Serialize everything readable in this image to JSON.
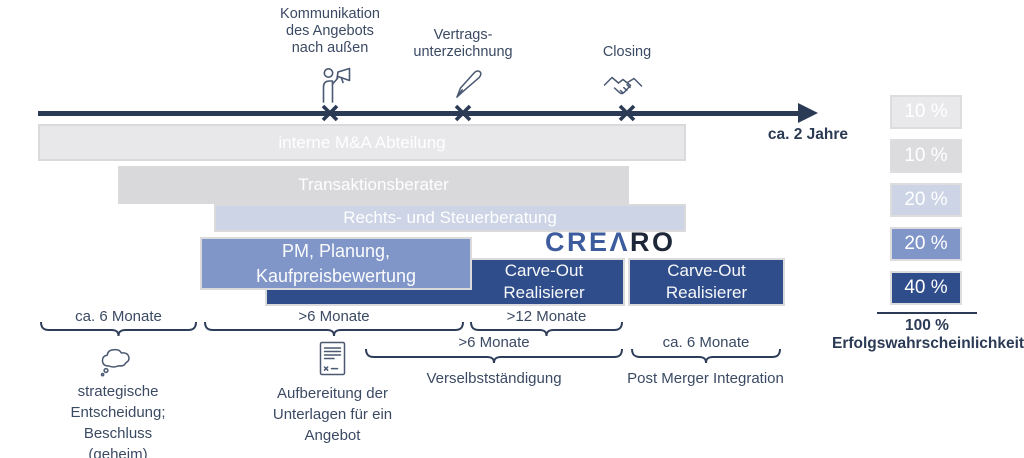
{
  "timeline": {
    "duration_label": "ca. 2 Jahre",
    "milestones": [
      {
        "label": "Kommunikation\ndes Angebots\nnach außen",
        "icon": "megaphone-person-icon"
      },
      {
        "label": "Vertrags-\nunterzeichnung",
        "icon": "pen-icon"
      },
      {
        "label": "Closing",
        "icon": "handshake-icon"
      }
    ]
  },
  "bars": [
    {
      "label": "interne M&A Abteilung",
      "color": "#e8e8eb"
    },
    {
      "label": "Transaktionsberater",
      "color": "#d9d9dc"
    },
    {
      "label": "Rechts- und Steuerberatung",
      "color": "#ccd4e6"
    },
    {
      "label": "PM, Planung,\nKaufpreisbewertung",
      "color": "#8096c8"
    },
    {
      "label": "Carve-Out\nRealisierer",
      "color": "#2f4d8a"
    },
    {
      "label": "Carve-Out\nRealisierer",
      "color": "#2f4d8a"
    }
  ],
  "logo": {
    "part1": "CRE",
    "part2": "Λ",
    "part3": "RO",
    "color_primary": "#3d5c9e",
    "color_dark": "#1d2737"
  },
  "probabilities": {
    "items": [
      {
        "value": "10 %",
        "color": "#e9e9ec"
      },
      {
        "value": "10 %",
        "color": "#dcdcdf"
      },
      {
        "value": "20 %",
        "color": "#ccd4e6"
      },
      {
        "value": "20 %",
        "color": "#8096c8"
      },
      {
        "value": "40 %",
        "color": "#2f4d8a"
      }
    ],
    "total_value": "100 %",
    "total_label": "Erfolgswahrscheinlichkeit"
  },
  "phases": {
    "row1": [
      {
        "label": "ca. 6 Monate"
      },
      {
        "label": ">6 Monate"
      },
      {
        "label": ">12 Monate"
      }
    ],
    "row2": [
      {
        "label": ">6 Monate"
      },
      {
        "label": "ca. 6 Monate"
      }
    ]
  },
  "notes": [
    {
      "icon": "thought-bubble-icon",
      "text": "strategische\nEntscheidung;\nBeschluss\n(geheim)"
    },
    {
      "icon": "document-icon",
      "text": "Aufbereitung der\nUnterlagen für ein\nAngebot"
    },
    {
      "text": "Verselbstständigung"
    },
    {
      "text": "Post Merger Integration"
    }
  ]
}
